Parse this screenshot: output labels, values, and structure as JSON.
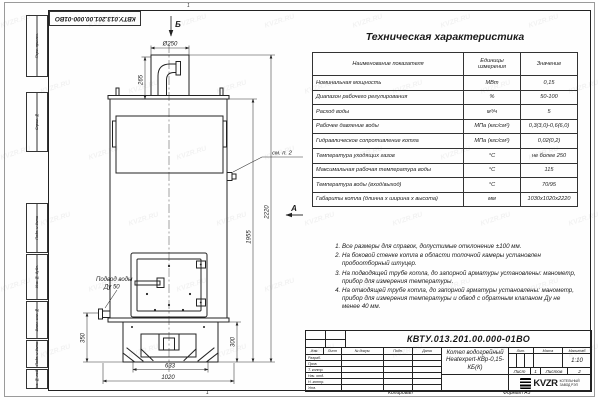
{
  "watermark": {
    "text": "KVZR.RU"
  },
  "frame": {
    "top_doc_number": "КВТУ.013.201.00.000-01ВО",
    "zone_top": "1",
    "side_labels": [
      "Перв. примен.",
      "Справ. №",
      "Подп. и дата",
      "Инв. № дубл.",
      "Взам. инв. №",
      "Подп. и дата",
      "Инв. № подл."
    ],
    "bottom": {
      "zone": "1",
      "copied_label": "Копировал",
      "format_label": "Формат А3"
    }
  },
  "spec_table": {
    "title": "Техническая характеристика",
    "headers": {
      "name": "Наименование показателя",
      "units": "Единицы измерения",
      "value": "Значение"
    },
    "rows": [
      {
        "name": "Номинальная мощность",
        "unit": "МВт",
        "value": "0,15"
      },
      {
        "name": "Диапазон рабочего регулирования",
        "unit": "%",
        "value": "50-100"
      },
      {
        "name": "Расход воды",
        "unit": "м³/ч",
        "value": "5"
      },
      {
        "name": "Рабочее давление воды",
        "unit": "МПа (кгс/см²)",
        "value": "0,3(3,0)-0,6(6,0)"
      },
      {
        "name": "Гидравлическое сопротивление котла",
        "unit": "МПа (кгс/см²)",
        "value": "0,02(0,2)"
      },
      {
        "name": "Температура уходящих газов",
        "unit": "°С",
        "value": "не более 250"
      },
      {
        "name": "Максимальная рабочая температура воды",
        "unit": "°С",
        "value": "115"
      },
      {
        "name": "Температура воды (вход/выход)",
        "unit": "°С",
        "value": "70/95"
      },
      {
        "name": "Габариты котла (длинна х ширина х высота)",
        "unit": "мм",
        "value": "1030х1020х2220"
      }
    ]
  },
  "notes": {
    "items": [
      "Все размеры для справок, допустимые отклонение ±100 мм.",
      "На боковой стенке котла в области топочной камеры установлен пробоотборный штуцер.",
      "На подводящей трубе котла, до запорной арматуры установлены: манометр, прибор для измерения температуры.",
      "На отводящей трубе котла, до запорной арматуры установлены: манометр, прибор для измерения температуры и обвод с обратным клапаном Ду не менее 40 мм."
    ]
  },
  "drawing": {
    "view_b": "Б",
    "view_a": "А",
    "dia_top": "Ø250",
    "dim_265": "265",
    "dim_2220": "2220",
    "dim_1955": "1955",
    "dim_350": "350",
    "dim_300": "300",
    "dim_633": "633",
    "dim_1020": "1020",
    "see_note": "см. п. 2",
    "inlet_line1": "Подвод воды",
    "inlet_line2": "Ду 50"
  },
  "title_block": {
    "doc_number": "КВТУ.013.201.00.000-01ВО",
    "name_line1": "Котел водогрейный",
    "name_line2": "Heatexpert-КВр-0,15-КБ(К)",
    "col_izm": "Изм.",
    "col_list": "Лист",
    "col_doc": "№ докум.",
    "col_sign": "Подп.",
    "col_date": "Дата",
    "row_labels": [
      "Разраб.",
      "Пров.",
      "Т. контр.",
      "Нач. отд.",
      "Н. контр.",
      "Утв."
    ],
    "lit": "Лит.",
    "mass": "Масса",
    "scale": "Масштаб",
    "scale_value": "1:10",
    "sheet": "Лист",
    "sheet_no": "1",
    "sheets": "Листов",
    "sheets_no": "2",
    "logo_text": "KVZR",
    "company_line1": "КОТЕЛЬНЫЙ",
    "company_line2": "ЗАВОД РЭП"
  }
}
